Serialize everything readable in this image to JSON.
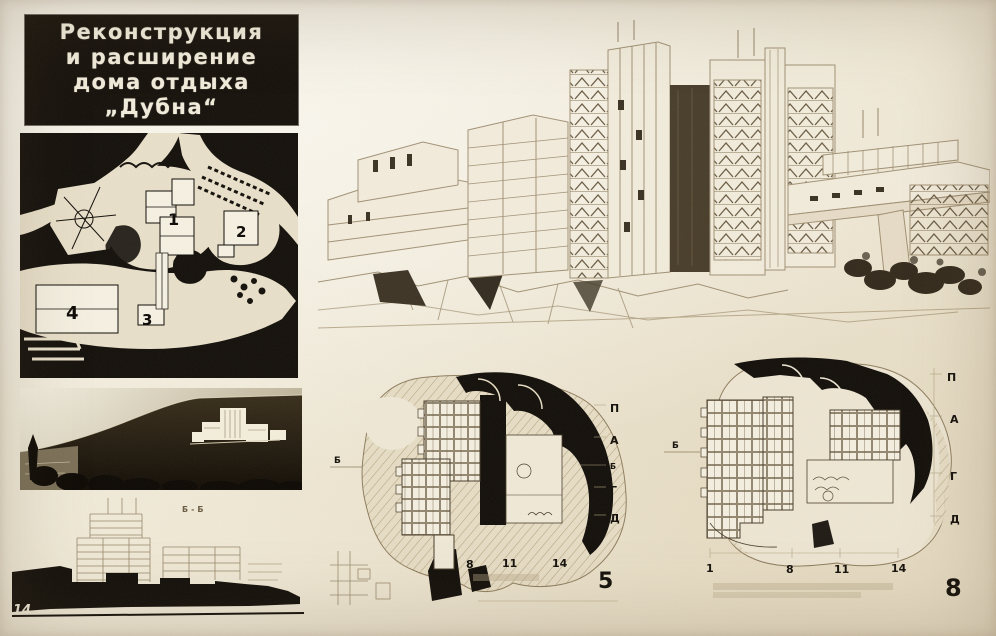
{
  "board": {
    "title_lines": [
      "Реконструкция",
      "и расширение",
      "дома отдыха",
      "„Дубна“"
    ]
  },
  "site_plan": {
    "building_labels": [
      "1",
      "2",
      "3",
      "4"
    ]
  },
  "section": {
    "section_label": "Б-Б",
    "sheet_number": "14"
  },
  "plan_level_5": {
    "left_axis_label": "Б",
    "right_axis_labels": [
      "П",
      "А",
      "Б",
      "Г",
      "Д"
    ],
    "column_numbers": [
      "8",
      "11",
      "14"
    ],
    "sheet_number": "5"
  },
  "plan_level_8": {
    "left_axis_label": "Б",
    "right_axis_labels": [
      "П",
      "А",
      "Г",
      "Д"
    ],
    "column_numbers": [
      "1",
      "8",
      "11",
      "14"
    ],
    "sheet_number": "8"
  },
  "colors": {
    "paper": "#efe8d6",
    "ink_black": "#16110b",
    "sepia_line": "#93815f",
    "title_text": "#f2ecdb"
  }
}
